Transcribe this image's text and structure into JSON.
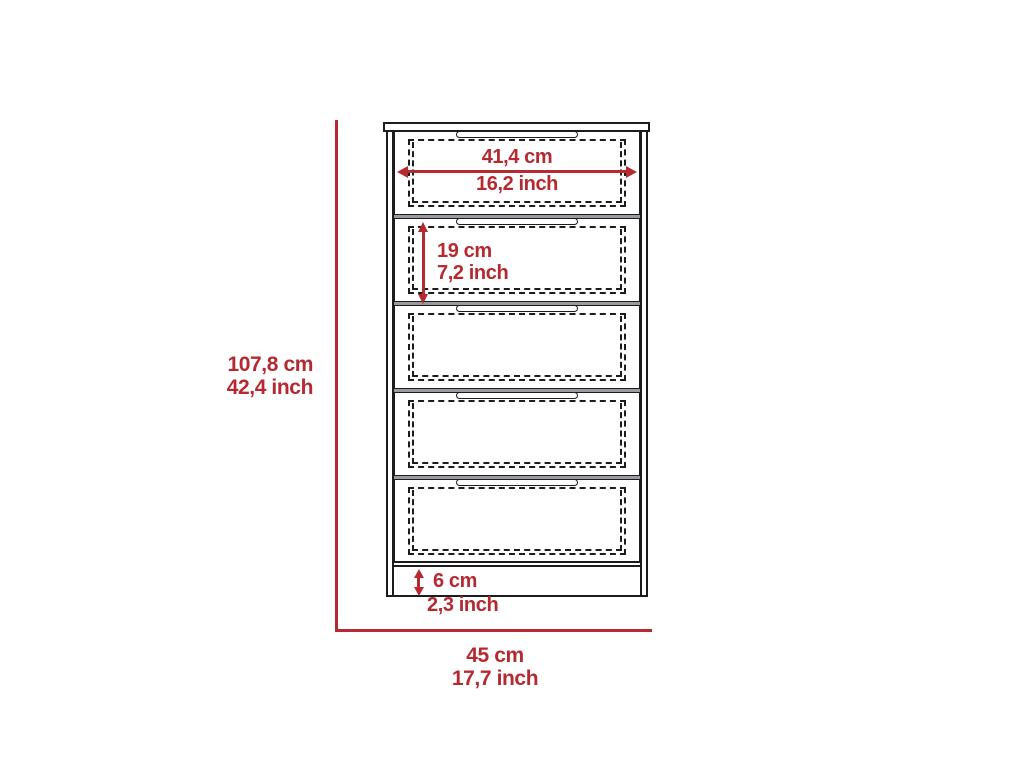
{
  "diagram": {
    "subject": "5-drawer dresser dimension diagram",
    "drawer_count": 5,
    "colors": {
      "accent": "#b42a30",
      "line": "#1c1c1c",
      "divider": "#9a9aa0",
      "background": "#ffffff"
    },
    "dimensions": {
      "drawer_width": {
        "cm": "41,4 cm",
        "inch": "16,2 inch"
      },
      "drawer_height": {
        "cm": "19 cm",
        "inch": "7,2 inch"
      },
      "total_height": {
        "cm": "107,8 cm",
        "inch": "42,4 inch"
      },
      "base_height": {
        "cm": "6 cm",
        "inch": "2,3 inch"
      },
      "total_width": {
        "cm": "45 cm",
        "inch": "17,7 inch"
      }
    }
  }
}
